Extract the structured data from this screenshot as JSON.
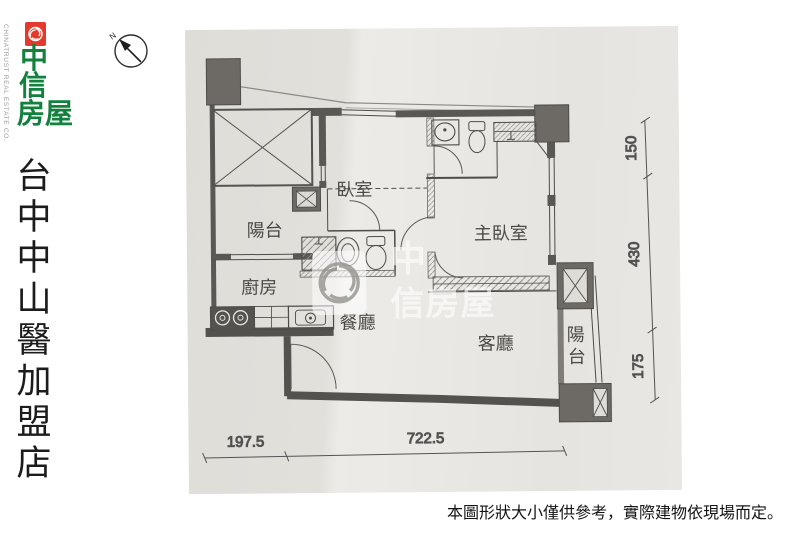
{
  "branding": {
    "tagline": "CHINATRUST REAL ESTATE CO.",
    "logo_rows": [
      "中",
      "信",
      "房屋"
    ],
    "store_name_chars": [
      "台",
      "中",
      "中",
      "山",
      "醫",
      "加",
      "盟",
      "店"
    ]
  },
  "compass": {
    "north_label": "N"
  },
  "floor_plan": {
    "rooms": {
      "bedroom": "臥室",
      "master_bedroom": "主臥室",
      "balcony_left": "陽台",
      "kitchen": "廚房",
      "dining": "餐廳",
      "living": "客廳",
      "balcony_right_chars": [
        "陽",
        "台"
      ]
    },
    "dimensions": {
      "right_top": "150",
      "right_middle": "430",
      "right_bottom": "175",
      "bottom_left": "197.5",
      "bottom_right": "722.5"
    }
  },
  "watermark": {
    "line1": "中",
    "line2": "信房屋"
  },
  "disclaimer": "本圖形狀大小僅供參考，實際建物依現場而定。",
  "colors": {
    "logo_red": "#e23b2e",
    "logo_green": "#12813d",
    "plan_ink": "#4e4c49",
    "column_fill": "#6d6a66",
    "photo_paper": "#e4e2dd"
  }
}
